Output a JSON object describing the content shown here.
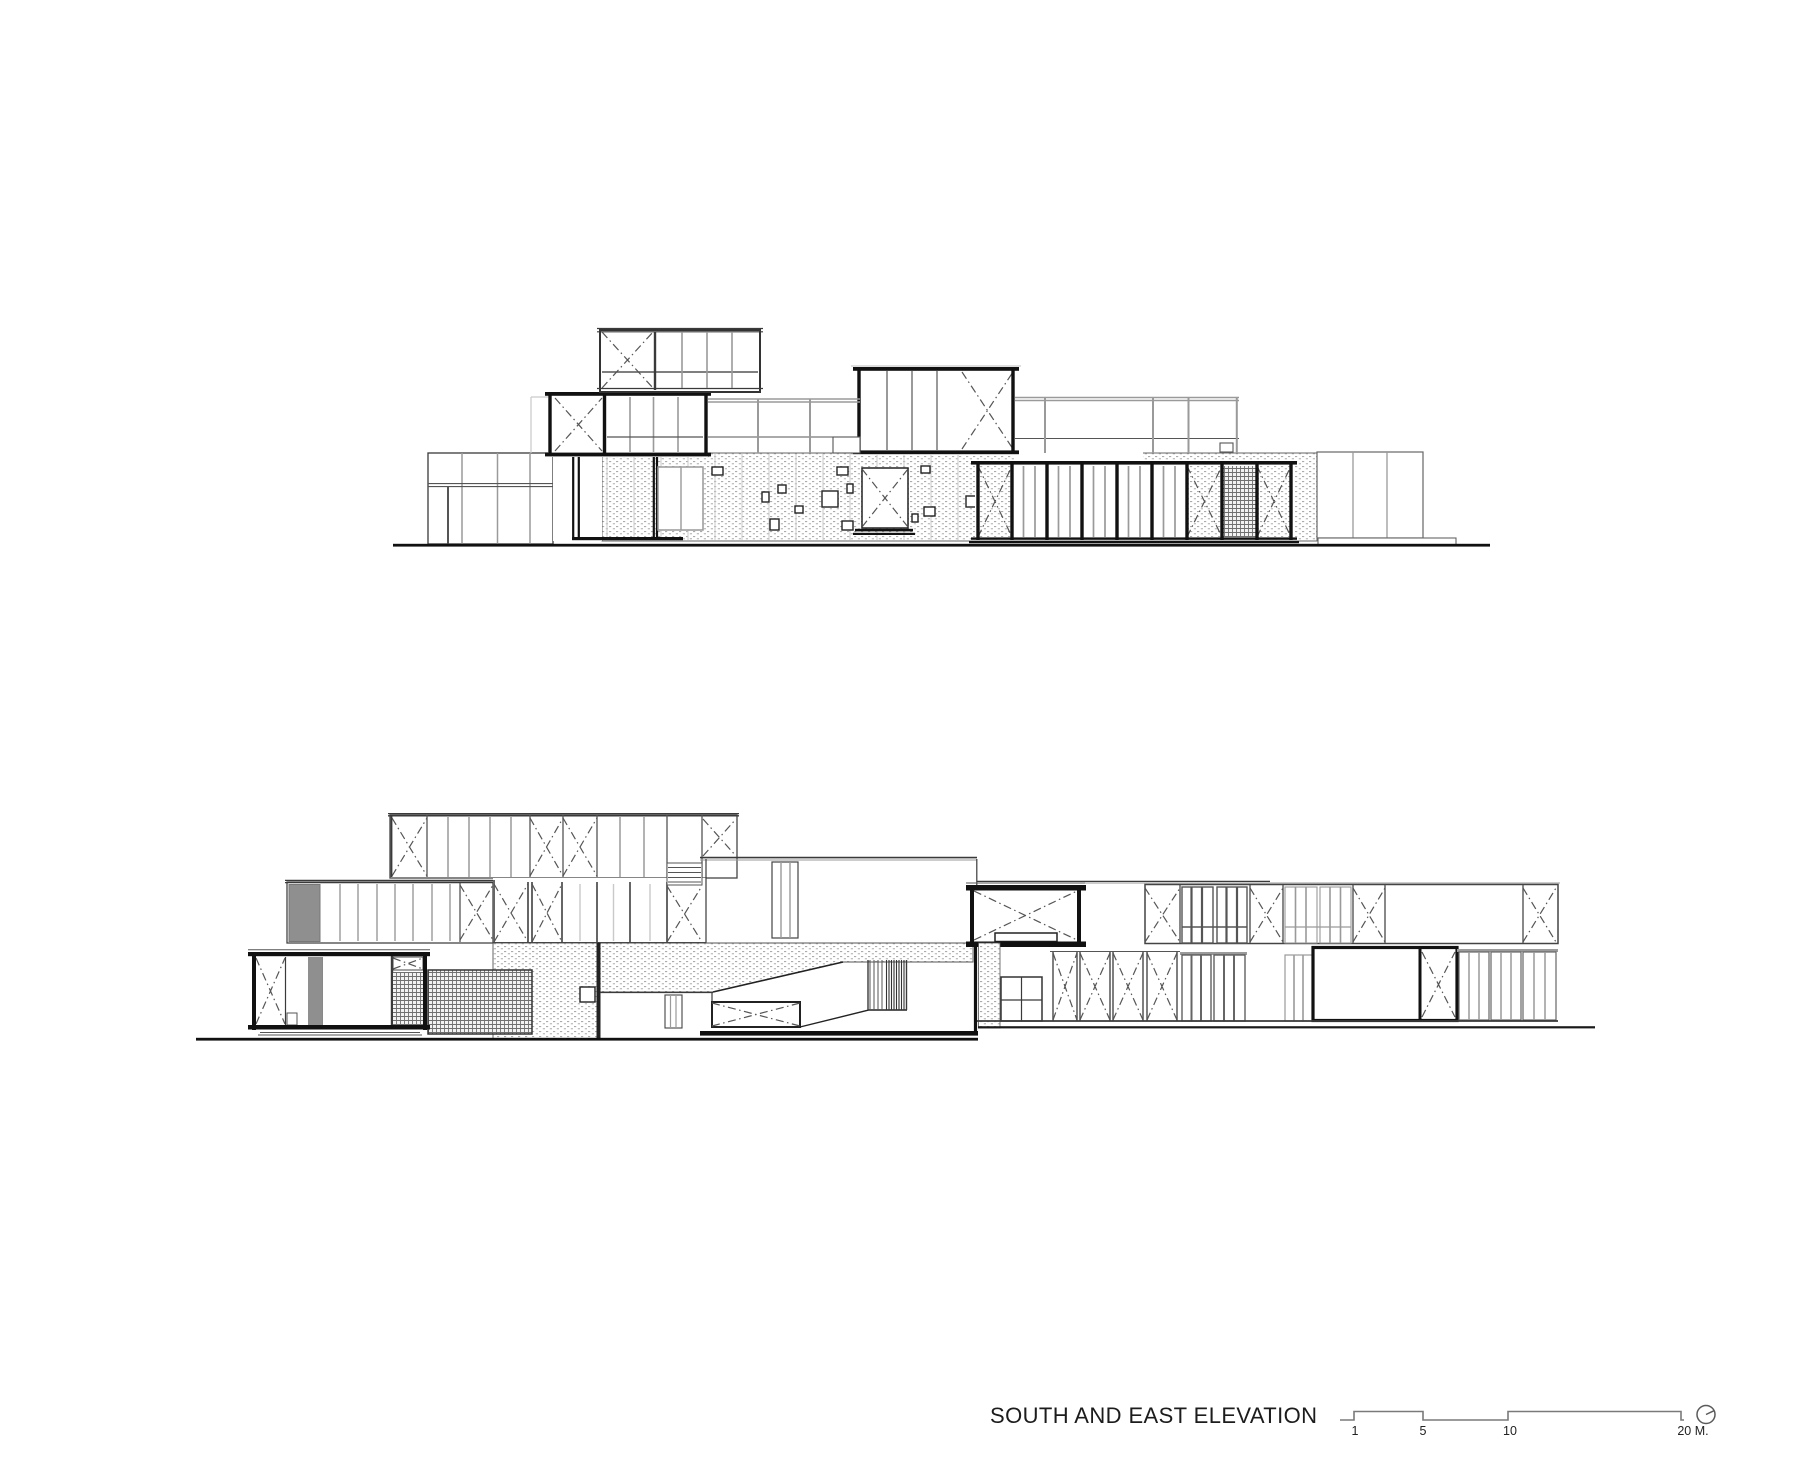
{
  "title": {
    "label": "SOUTH AND EAST ELEVATION"
  },
  "scale_bar": {
    "labels": [
      "1",
      "5",
      "10",
      "20 M."
    ]
  },
  "symbols": {
    "north_icon": "circle-with-pointer"
  },
  "colors": {
    "background": "#ffffff",
    "ink": "#111111",
    "medium_line": "#3a3a3a",
    "gray_mullion": "#9a9a9a",
    "panel_gray": "#8f8f8f",
    "stipple_dot": "#ababab",
    "hatch_line": "#6f6f6f"
  }
}
